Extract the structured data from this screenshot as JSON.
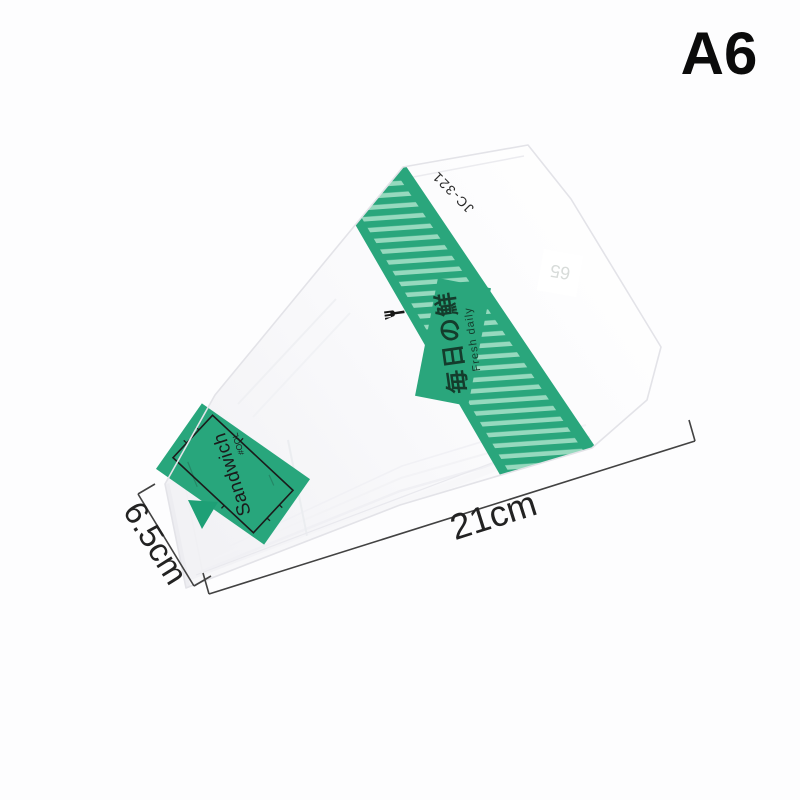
{
  "annotation": {
    "size_code": "A6",
    "length_label": "21cm",
    "width_label": "6.5cm"
  },
  "package": {
    "model": "JC-321",
    "corner_badge": "65",
    "band_label_main": "毎日の鮮",
    "band_label_sub": "Fresh daily",
    "tip_panel_title": "Sandwich",
    "tip_panel_sub": "#OOL",
    "colors": {
      "band_green": "#2aa67c",
      "stripe_light": "#96d9be",
      "panel_green": "#28a67c",
      "triangle_green": "#1ea076",
      "label_ink": "#143c2c",
      "panel_ink": "#1b1b1b"
    }
  }
}
